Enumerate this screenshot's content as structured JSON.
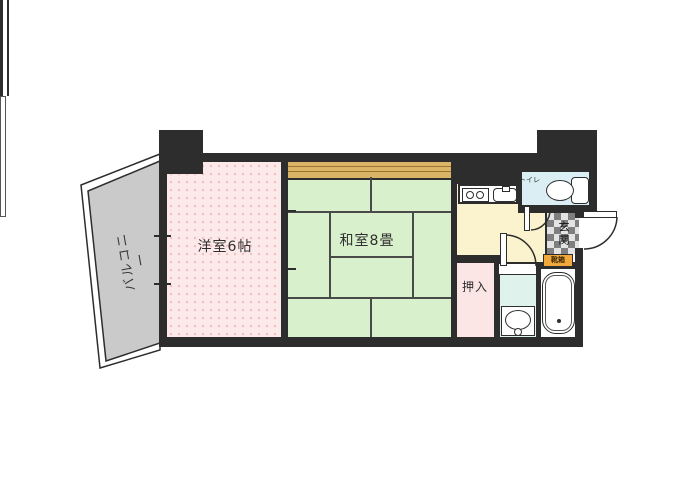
{
  "plan": {
    "type": "apartment-floor-plan",
    "labels": {
      "balcony": "バルコニー",
      "western_room": "洋室6帖",
      "japanese_room": "和室8畳",
      "closet": "押入",
      "toilet": "トイレ",
      "entrance": "玄関",
      "shoe_cabinet": "靴箱"
    },
    "fixtures": [
      "stove-icon",
      "sink-icon",
      "toilet-icon",
      "bathtub-icon",
      "washbasin-icon",
      "entrance-door",
      "toilet-door",
      "washroom-door",
      "balcony-window",
      "fusuma-opening"
    ],
    "colors": {
      "wall": "#2d2d2d",
      "western_room": "#fce9e9",
      "tatami": "#d9f0cc",
      "wood_strip": "#d9b366",
      "kitchen_hall": "#faf3cd",
      "toilet_room": "#daeef4",
      "washroom": "#e0f2ec",
      "closet": "#fbe5e5",
      "balcony": "#cacaca",
      "shoe_cabinet": "#f2a93c",
      "bath": "#ffffff"
    }
  }
}
